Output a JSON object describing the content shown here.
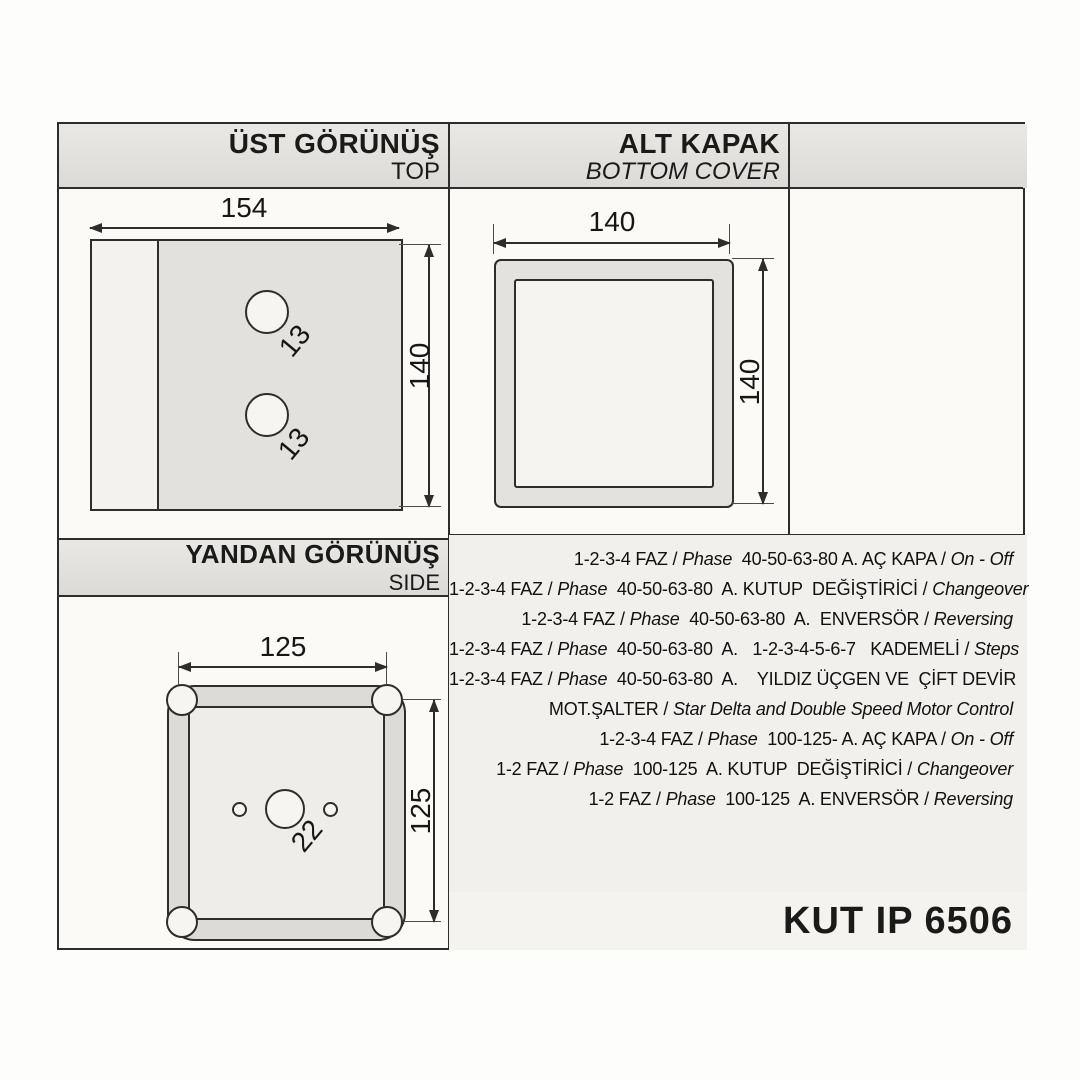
{
  "document": {
    "product_code": "KUT IP 6506",
    "sections": {
      "top_view": {
        "title": "ÜST GÖRÜNÜŞ",
        "subtitle": "TOP"
      },
      "bottom_cover": {
        "title": "ALT KAPAK",
        "subtitle": "BOTTOM COVER"
      },
      "side_view": {
        "title": "YANDAN GÖRÜNÜŞ",
        "subtitle": "SIDE"
      }
    },
    "dimensions": {
      "top_view": {
        "width": "154",
        "height": "140",
        "hole_upper": "13",
        "hole_lower": "13"
      },
      "bottom_cover": {
        "width": "140",
        "height": "140"
      },
      "side_view": {
        "width": "125",
        "height": "125",
        "center_hole": "22"
      }
    },
    "spec_lines": [
      [
        {
          "text": "1-2-3-4 FAZ / "
        },
        {
          "text": "Phase",
          "italic": true
        },
        {
          "text": "  40-50-63-80 A. AÇ KAPA / "
        },
        {
          "text": "On - Off",
          "italic": true
        }
      ],
      [
        {
          "text": "1-2-3-4 FAZ / "
        },
        {
          "text": "Phase",
          "italic": true
        },
        {
          "text": "  40-50-63-80  A. KUTUP  DEĞİŞTİRİCİ / "
        },
        {
          "text": "Changeover",
          "italic": true
        }
      ],
      [
        {
          "text": "1-2-3-4 FAZ / "
        },
        {
          "text": "Phase",
          "italic": true
        },
        {
          "text": "  40-50-63-80  A.  ENVERSÖR / "
        },
        {
          "text": "Reversing",
          "italic": true
        }
      ],
      [
        {
          "text": "1-2-3-4 FAZ / "
        },
        {
          "text": "Phase",
          "italic": true
        },
        {
          "text": "  40-50-63-80  A.   1-2-3-4-5-6-7   KADEMELİ / "
        },
        {
          "text": "Steps",
          "italic": true
        }
      ],
      [
        {
          "text": "1-2-3-4 FAZ / "
        },
        {
          "text": "Phase",
          "italic": true
        },
        {
          "text": "  40-50-63-80  A.    YILDIZ ÜÇGEN VE  ÇİFT DEVİR"
        }
      ],
      [
        {
          "text": "MOT.ŞALTER / "
        },
        {
          "text": "Star Delta and Double Speed Motor Control",
          "italic": true
        }
      ],
      [
        {
          "text": "1-2-3-4 FAZ / "
        },
        {
          "text": "Phase",
          "italic": true
        },
        {
          "text": "  100-125- A. AÇ KAPA / "
        },
        {
          "text": "On - Off",
          "italic": true
        }
      ],
      [
        {
          "text": "1-2 FAZ / "
        },
        {
          "text": "Phase",
          "italic": true
        },
        {
          "text": "  100-125  A. KUTUP  DEĞİŞTİRİCİ / "
        },
        {
          "text": "Changeover",
          "italic": true
        }
      ],
      [
        {
          "text": "1-2 FAZ / "
        },
        {
          "text": "Phase",
          "italic": true
        },
        {
          "text": "  100-125  A. ENVERSÖR / "
        },
        {
          "text": "Reversing",
          "italic": true
        }
      ]
    ]
  }
}
